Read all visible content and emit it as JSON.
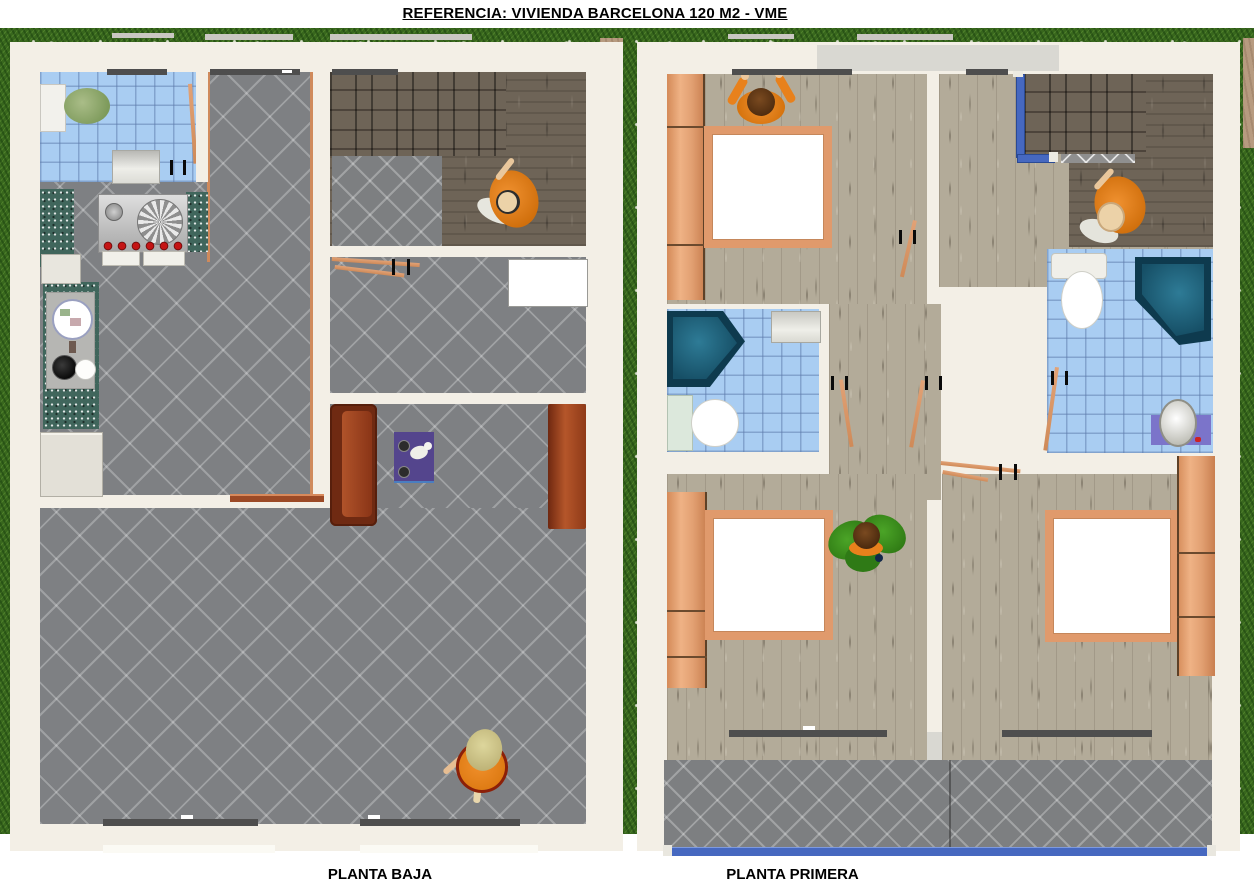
{
  "header": {
    "title": "REFERENCIA: VIVIENDA BARCELONA 120 M2 - VME"
  },
  "floors": [
    {
      "id": "planta-baja",
      "label": "PLANTA BAJA"
    },
    {
      "id": "planta-primera",
      "label": "PLANTA PRIMERA"
    }
  ],
  "colors": {
    "grass": "#38671d",
    "plan_sheet": "#f3efe6",
    "tile_gray": "#7e8083",
    "tile_blue": "#a9cdf2",
    "wood_light": "#b3ab99",
    "wood_dark": "#6e6457",
    "wood_orange": "#e2a072",
    "kitchen_counter_teal": "#40665c",
    "bathtub_teal": "#1d6079",
    "sofa_red": "#7e2f16",
    "rug_purple": "#54458d",
    "railing_blue": "#4668c0",
    "person_orange": "#e8811c",
    "person_green": "#3b8a1d",
    "window_band": "#4e4e4e"
  }
}
